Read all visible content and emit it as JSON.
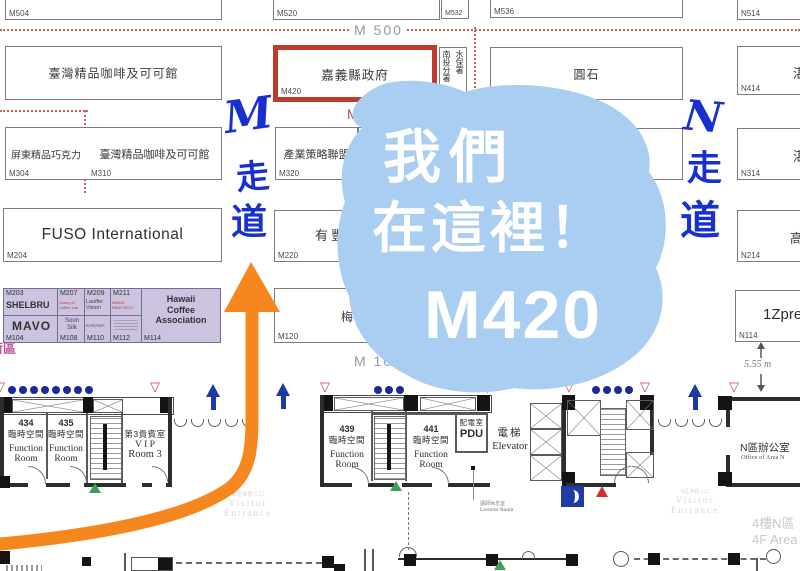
{
  "bubble": {
    "line1": "我們",
    "line2": "在這裡！",
    "line3": "M420"
  },
  "walkways": {
    "m": [
      "M",
      "走",
      "道"
    ],
    "n": [
      "N",
      "走",
      "道"
    ]
  },
  "aisle_labels": {
    "m500": "M 500",
    "m400": "M 400",
    "m100": "M 100"
  },
  "booths": {
    "m504": {
      "id": "M504"
    },
    "m520": {
      "id": "M520"
    },
    "m532": {
      "id": "M532"
    },
    "m536": {
      "id": "M536"
    },
    "n514": {
      "id": "N514"
    },
    "taiwan_coffee_top": {
      "name": "臺灣精品咖啡及可可館"
    },
    "chiayi_gov": {
      "name": "嘉義縣政府",
      "id": "M420"
    },
    "swcb": {
      "col_left": "南投分署",
      "col_right": "水保署"
    },
    "yuanshi": {
      "name": "圓石"
    },
    "n414": {
      "id": "N414",
      "partial": "湛"
    },
    "pingtung": {
      "name": "屏東精品巧克力",
      "id": "M304"
    },
    "taiwan_coffee_mid": {
      "name": "臺灣精品咖啡及可可館",
      "id": "M310"
    },
    "strategy": {
      "name": "產業策略聯盟",
      "id": "M320"
    },
    "wang": {
      "partial": "旺"
    },
    "gov_partial": {
      "partial": "府"
    },
    "n314": {
      "id": "N314",
      "partial": "湛"
    },
    "fuso": {
      "name": "FUSO International",
      "id": "M204"
    },
    "youfeng": {
      "name": "有豐",
      "id": "M220"
    },
    "n214": {
      "id": "N214",
      "partial": "高"
    },
    "meizhen": {
      "name": "梅珍香",
      "id": "M120"
    },
    "onezpresso": {
      "name": "1Zpre",
      "id": "N114"
    }
  },
  "purple_block": {
    "m203": {
      "id": "M203",
      "name": "SHELBRU"
    },
    "m207": {
      "id": "M207",
      "name": "Sunny M Coffee Lab"
    },
    "m209": {
      "id": "M209",
      "name": "Lauffer Vision"
    },
    "m211": {
      "id": "M211",
      "name": "ANHUI REALTECH"
    },
    "m104": {
      "id": "M104",
      "name": "MAVO"
    },
    "m108": {
      "id": "M108",
      "name": "Soon Silk"
    },
    "m110": {
      "id": "M110",
      "name": "KARANA"
    },
    "m112": {
      "id": "M112"
    },
    "m114": {
      "id": "M114",
      "lines": [
        "Hawaii",
        "Coffee",
        "Association"
      ]
    }
  },
  "area_label": "荷區",
  "rooms": {
    "r434": {
      "num": "434",
      "zh": "臨時空間",
      "en1": "Function",
      "en2": "Room"
    },
    "r435": {
      "num": "435",
      "zh": "臨時空間",
      "en1": "Function",
      "en2": "Room"
    },
    "vip3": {
      "zh": "第3貴賓室",
      "en1": "V I P",
      "en2": "Room 3"
    },
    "r439": {
      "num": "439",
      "zh": "臨時空間",
      "en1": "Function",
      "en2": "Room"
    },
    "r441": {
      "num": "441",
      "zh": "臨時空間",
      "en1": "Function",
      "en2": "Room"
    },
    "pdu": {
      "zh": "配電室",
      "en": "PDU"
    },
    "elevator": {
      "zh": "電梯",
      "en": "Elevator"
    },
    "lecturer": {
      "zh": "講師休息室",
      "en": "Lecturer Room"
    },
    "n_office": {
      "zh": "N區辦公室",
      "en": "Office of Area N"
    }
  },
  "annotations": {
    "dimension": "5.55 m",
    "visitor_left": {
      "zh": "M區參觀入口",
      "en1": "Visitor",
      "en2": "Entrance"
    },
    "visitor_right": {
      "zh": "N區參觀入口",
      "en1": "Visitor",
      "en2": "Entrance"
    },
    "floor": {
      "zh": "4樓N區",
      "en": "4F Area"
    }
  },
  "colors": {
    "bubble": "#A9CEF1",
    "arrow": "#F6871F",
    "handwriting": "#1730CF",
    "highlight_border": "#C0392B",
    "purple_bg": "#CBC3DF"
  }
}
